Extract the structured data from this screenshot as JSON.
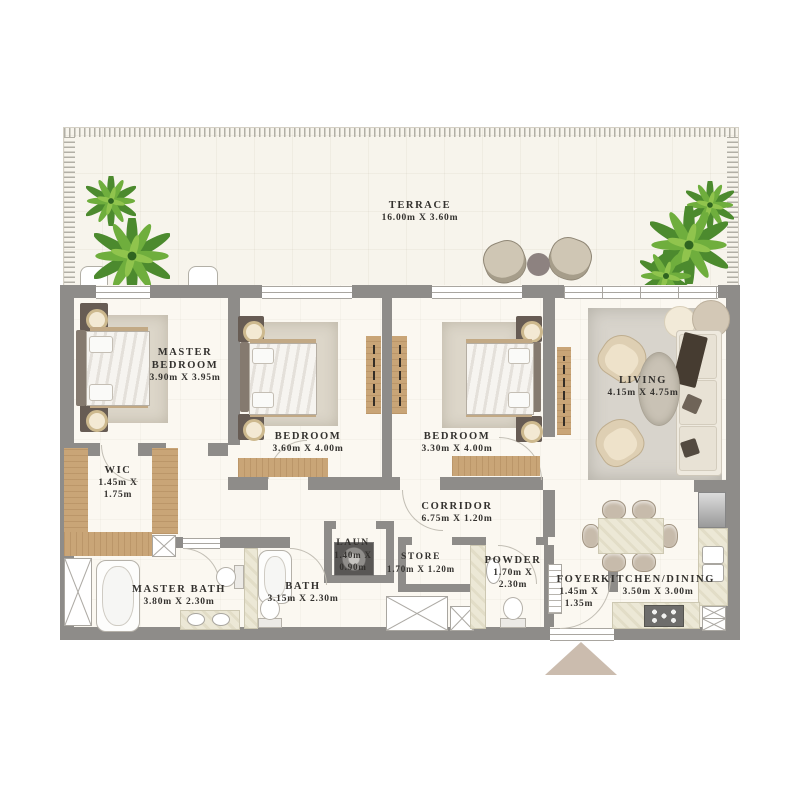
{
  "terrace": {
    "name": "TERRACE",
    "dims": "16.00m X 3.60m"
  },
  "rooms": {
    "master_bedroom": {
      "name": "MASTER BEDROOM",
      "dims": "3.90m X 3.95m"
    },
    "bedroom_2": {
      "name": "BEDROOM",
      "dims": "3.60m X 4.00m"
    },
    "bedroom_3": {
      "name": "BEDROOM",
      "dims": "3.30m X 4.00m"
    },
    "living": {
      "name": "LIVING",
      "dims": "4.15m X 4.75m"
    },
    "wic": {
      "name": "WIC",
      "dims_l1": "1.45m X",
      "dims_l2": "1.75m"
    },
    "corridor": {
      "name": "CORRIDOR",
      "dims": "6.75m X 1.20m"
    },
    "master_bath": {
      "name": "MASTER BATH",
      "dims": "3.80m X 2.30m"
    },
    "bath": {
      "name": "BATH",
      "dims": "3.15m X 2.30m"
    },
    "laundry": {
      "name": "LAUN",
      "dims_l1": "1.40m X",
      "dims_l2": "0.90m"
    },
    "store": {
      "name": "STORE",
      "dims": "1.70m X 1.20m"
    },
    "powder": {
      "name": "POWDER",
      "dims_l1": "1.70m X",
      "dims_l2": "2.30m"
    },
    "foyer": {
      "name": "FOYER",
      "dims_l1": "1.45m X",
      "dims_l2": "1.35m"
    },
    "kitchen_dining": {
      "name": "KITCHEN/DINING",
      "dims": "3.50m X 3.00m"
    }
  },
  "colors": {
    "wall": "#8e8c89",
    "wood": "#c9a577",
    "unit_floor": "#fbf8f1",
    "terrace_floor": "#f7f4ec",
    "plant_green": "#5d9a3c",
    "entry_arrow": "#cbbcae"
  }
}
